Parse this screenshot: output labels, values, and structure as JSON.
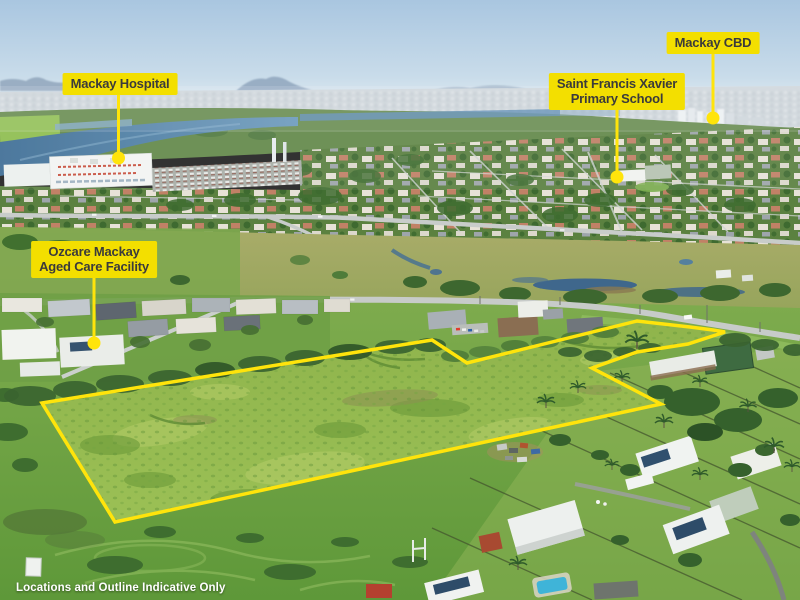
{
  "colors": {
    "label_bg": "#F3DF00",
    "label_text": "#3B3B3B",
    "outline_yellow": "#FFE40B",
    "disclaimer_text": "#FFFFFF"
  },
  "callouts": {
    "hospital": {
      "label": "Mackay Hospital"
    },
    "cbd": {
      "label": "Mackay CBD"
    },
    "school": {
      "line1": "Saint Francis Xavier",
      "line2": "Primary School"
    },
    "ozcare": {
      "line1": "Ozcare Mackay",
      "line2": "Aged Care Facility"
    }
  },
  "disclaimer": "Locations and Outline Indicative Only"
}
